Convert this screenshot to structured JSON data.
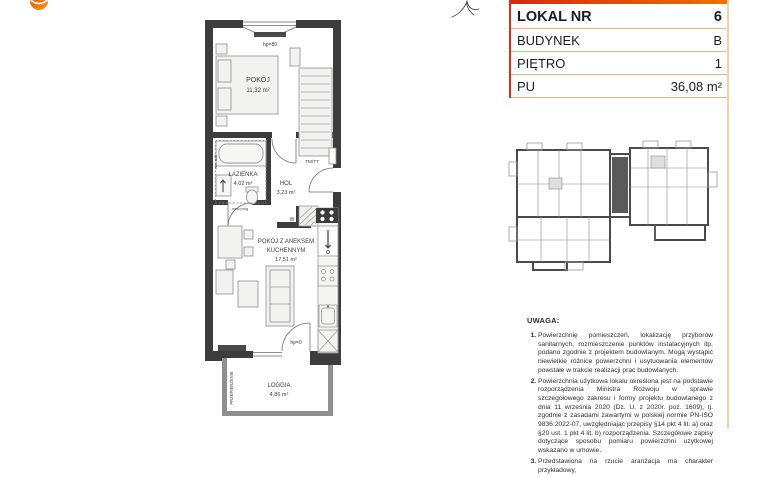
{
  "logo": {
    "text": "GRUPA DOM DEVELOPMENT"
  },
  "info_table": {
    "rows": [
      {
        "label": "LOKAL NR",
        "value": "6"
      },
      {
        "label": "BUDYNEK",
        "value": "B"
      },
      {
        "label": "PIĘTRO",
        "value": "1"
      },
      {
        "label": "PU",
        "value": "36,08 m²"
      }
    ]
  },
  "plan": {
    "rooms": {
      "pokoj": {
        "name": "POKÓJ",
        "area": "11,32 m²"
      },
      "lazienka": {
        "name": "ŁAZIENKA",
        "area": "4,02 m²"
      },
      "hol": {
        "name": "HOL",
        "area": "3,23 m²"
      },
      "pokoj_aneks": {
        "name_line1": "POKÓJ Z ANEKSEM",
        "name_line2": "KUCHENNYM",
        "area": "17,51 m²"
      },
      "loggia": {
        "name": "LOGGIA",
        "area": "4,86 m²"
      }
    },
    "annotations": {
      "window_sill": "hp=80",
      "door_sill": "hp=0",
      "tm_tt": "TM/TT",
      "water_meter": "W",
      "low_threshold": "niski próg",
      "partition": "PRZEPIERZENIE",
      "lowered_ceiling": "obn. sufit"
    }
  },
  "notes": {
    "heading": "UWAGA:",
    "items": [
      "Powierzchnię pomieszczeń, lokalizację przyborów sanitarnych, rozmieszczenie punktów instalacyjnych itp. podano zgodnie z projektem budowlanym. Mogą wystąpić niewielkie różnice powierzchni i usytuowania elementów powstałe w trakcie realizacji prac budowlanych.",
      "Powierzchnia użytkowa lokalu określona jest na podstawie rozporządzenia Ministra Rozwoju w sprawie szczegółowego zakresu i formy projektu budowlanego z dnia 11 września 2020 (Dz. U. z 2020r. poz. 1609), tj. zgodnie z zasadami zawartymi w polskiej normie PN-ISO 9836:2022-07, uwzględniając przepisy §14 pkt 4 lit. a) oraz §20 ust. 1 pkt 4 lit. b) rozporządzenia. Szczegółowe zapisy dotyczące sposobu pomiaru powierzchni użytkowej wskazano w umowie.",
      "Przedstawiona na rzucie aranżacja ma charakter przykładowy,"
    ]
  },
  "colors": {
    "accent_red": "#df2d12",
    "accent_orange": "#ee6f05",
    "table_line": "#f2b07a",
    "wall": "#3c3c3c",
    "highlight_unit": "#5a5a5a",
    "logo_orange": "#f07d00"
  }
}
